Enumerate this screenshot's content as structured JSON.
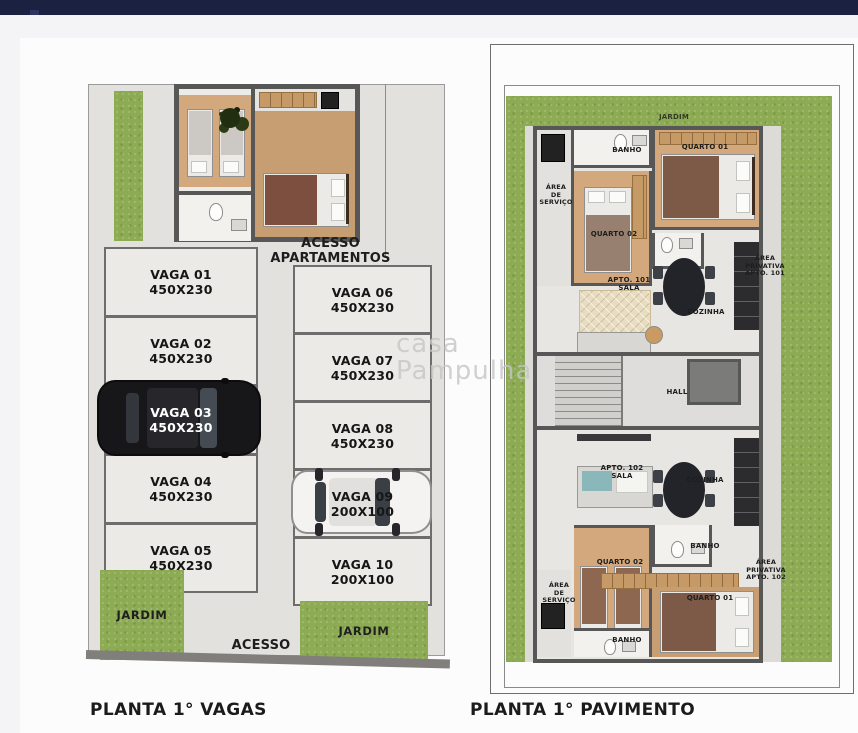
{
  "watermark": {
    "line1": "casa",
    "line2": "Pampulha"
  },
  "colors": {
    "topbar": "#1b2140",
    "page_bg": "#f4f4f6",
    "grass": "#8cab53",
    "wall": "#575757",
    "wood": "#d3a87c",
    "bath": "#f2f1ee",
    "car_black": "#17171a",
    "car_white": "#f4f3f1",
    "watermark": "#c6c6c6",
    "label": "#1d1d1d"
  },
  "left_plan": {
    "caption": "PLANTA 1° VAGAS",
    "labels": {
      "acesso_apartamentos": "ACESSO\nAPARTAMENTOS",
      "acesso": "ACESSO",
      "jardim_bottom_left": "JARDIM",
      "jardim_bottom_right": "JARDIM"
    },
    "stalls_left": [
      {
        "name": "VAGA 01",
        "size": "450X230"
      },
      {
        "name": "VAGA 02",
        "size": "450X230"
      },
      {
        "name": "VAGA 03",
        "size": "450X230",
        "car": "black-suv"
      },
      {
        "name": "VAGA 04",
        "size": "450X230"
      },
      {
        "name": "VAGA 05",
        "size": "450X230"
      }
    ],
    "stalls_right": [
      {
        "name": "VAGA 06",
        "size": "450X230"
      },
      {
        "name": "VAGA 07",
        "size": "450X230"
      },
      {
        "name": "VAGA 08",
        "size": "450X230"
      },
      {
        "name": "VAGA 09",
        "size": "200X100",
        "car": "white-car"
      },
      {
        "name": "VAGA 10",
        "size": "200X100"
      }
    ]
  },
  "right_plan": {
    "caption": "PLANTA 1° PAVIMENTO",
    "labels": {
      "jardim_top": "JARDIM",
      "hall": "HALL"
    },
    "apt101": {
      "banho": "BANHO",
      "quarto01": "QUARTO 01",
      "quarto02": "QUARTO 02",
      "area_servico": "ÁREA\nDE\nSERVIÇO",
      "sala": "APTO. 101\nSALA",
      "cozinha": "COZINHA",
      "area_privativa": "ÁREA\nPRIVATIVA\nAPTO. 101"
    },
    "apt102": {
      "sala": "APTO. 102\nSALA",
      "cozinha": "COZINHA",
      "quarto02": "QUARTO 02",
      "banho_mid": "BANHO",
      "banho_bottom": "BANHO",
      "quarto01": "QUARTO 01",
      "area_servico": "ÁREA\nDE\nSERVIÇO",
      "area_privativa": "ÁREA\nPRIVATIVA\nAPTO. 102"
    }
  }
}
